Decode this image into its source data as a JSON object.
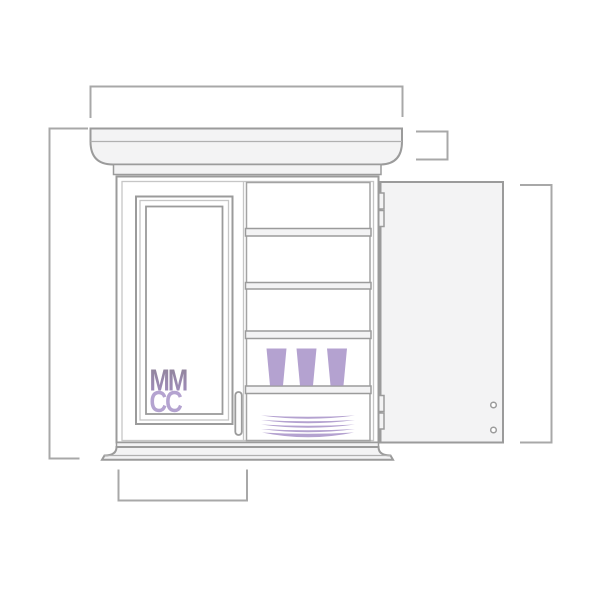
{
  "figure": {
    "logo": {
      "line1": "MM",
      "line2": "CC"
    }
  },
  "dimension_markers": [
    "overall-width-bracket",
    "overall-height-bracket",
    "crown-height-bracket",
    "open-door-height-bracket",
    "door-width-bracket"
  ],
  "colors": {
    "background": "#ffffff",
    "line": "#9b9b9b",
    "line_mid": "#a3a3a3",
    "line_light": "#b0b0b0",
    "line_lighter": "#c6c6c6",
    "panel": "#f3f3f4",
    "dim": "#a8a8a8",
    "accent": "#b4a2d0",
    "logo_mm_top": "#8f8496",
    "logo_mm_bottom": "#a18cc0",
    "logo_cc": "#b4a3d0"
  }
}
